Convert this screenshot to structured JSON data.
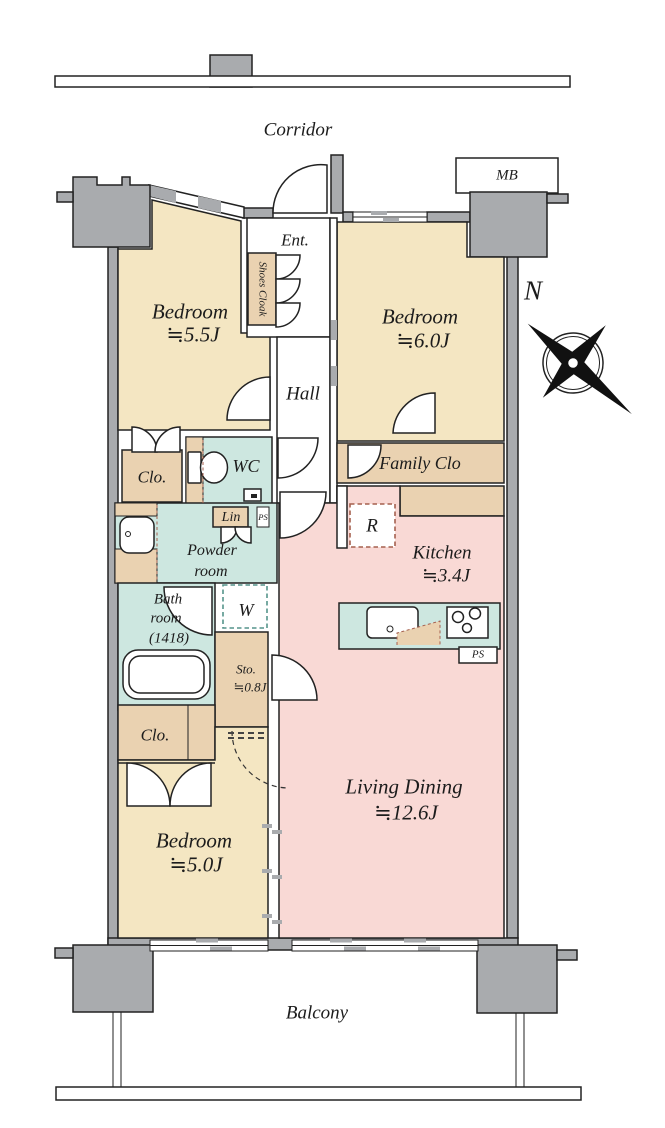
{
  "title": "3LDK apartment floor plan",
  "colors": {
    "beige": "#f4e6c2",
    "tan": "#ead2b1",
    "teal": "#cde7e0",
    "pink": "#f9d9d5",
    "wall": "#a9abae",
    "line": "#222222",
    "accent": "#a5604f",
    "accent2": "#55948b"
  },
  "labels": {
    "corridor": "Corridor",
    "balcony": "Balcony",
    "mb": "MB",
    "ent": "Ent.",
    "shoes_cloak": "Shoes Cloak",
    "hall": "Hall",
    "north": "N",
    "bedroom_a_name": "Bedroom",
    "bedroom_a_size": "≒5.5J",
    "bedroom_b_name": "Bedroom",
    "bedroom_b_size": "≒6.0J",
    "bedroom_c_name": "Bedroom",
    "bedroom_c_size": "≒5.0J",
    "living_name": "Living Dining",
    "living_size": "≒12.6J",
    "kitchen_name": "Kitchen",
    "kitchen_size": "≒3.4J",
    "bath_1": "Bath",
    "bath_2": "room",
    "bath_3": "(1418)",
    "powder_1": "Powder",
    "powder_2": "room",
    "wc": "WC",
    "clo_upper": "Clo.",
    "clo_lower": "Clo.",
    "family_clo": "Family Clo",
    "lin": "Lin",
    "ps_upper": "PS",
    "ps_kitchen": "PS",
    "sto_name": "Sto.",
    "sto_size": "≒0.8J",
    "washer": "W",
    "fridge": "R"
  }
}
